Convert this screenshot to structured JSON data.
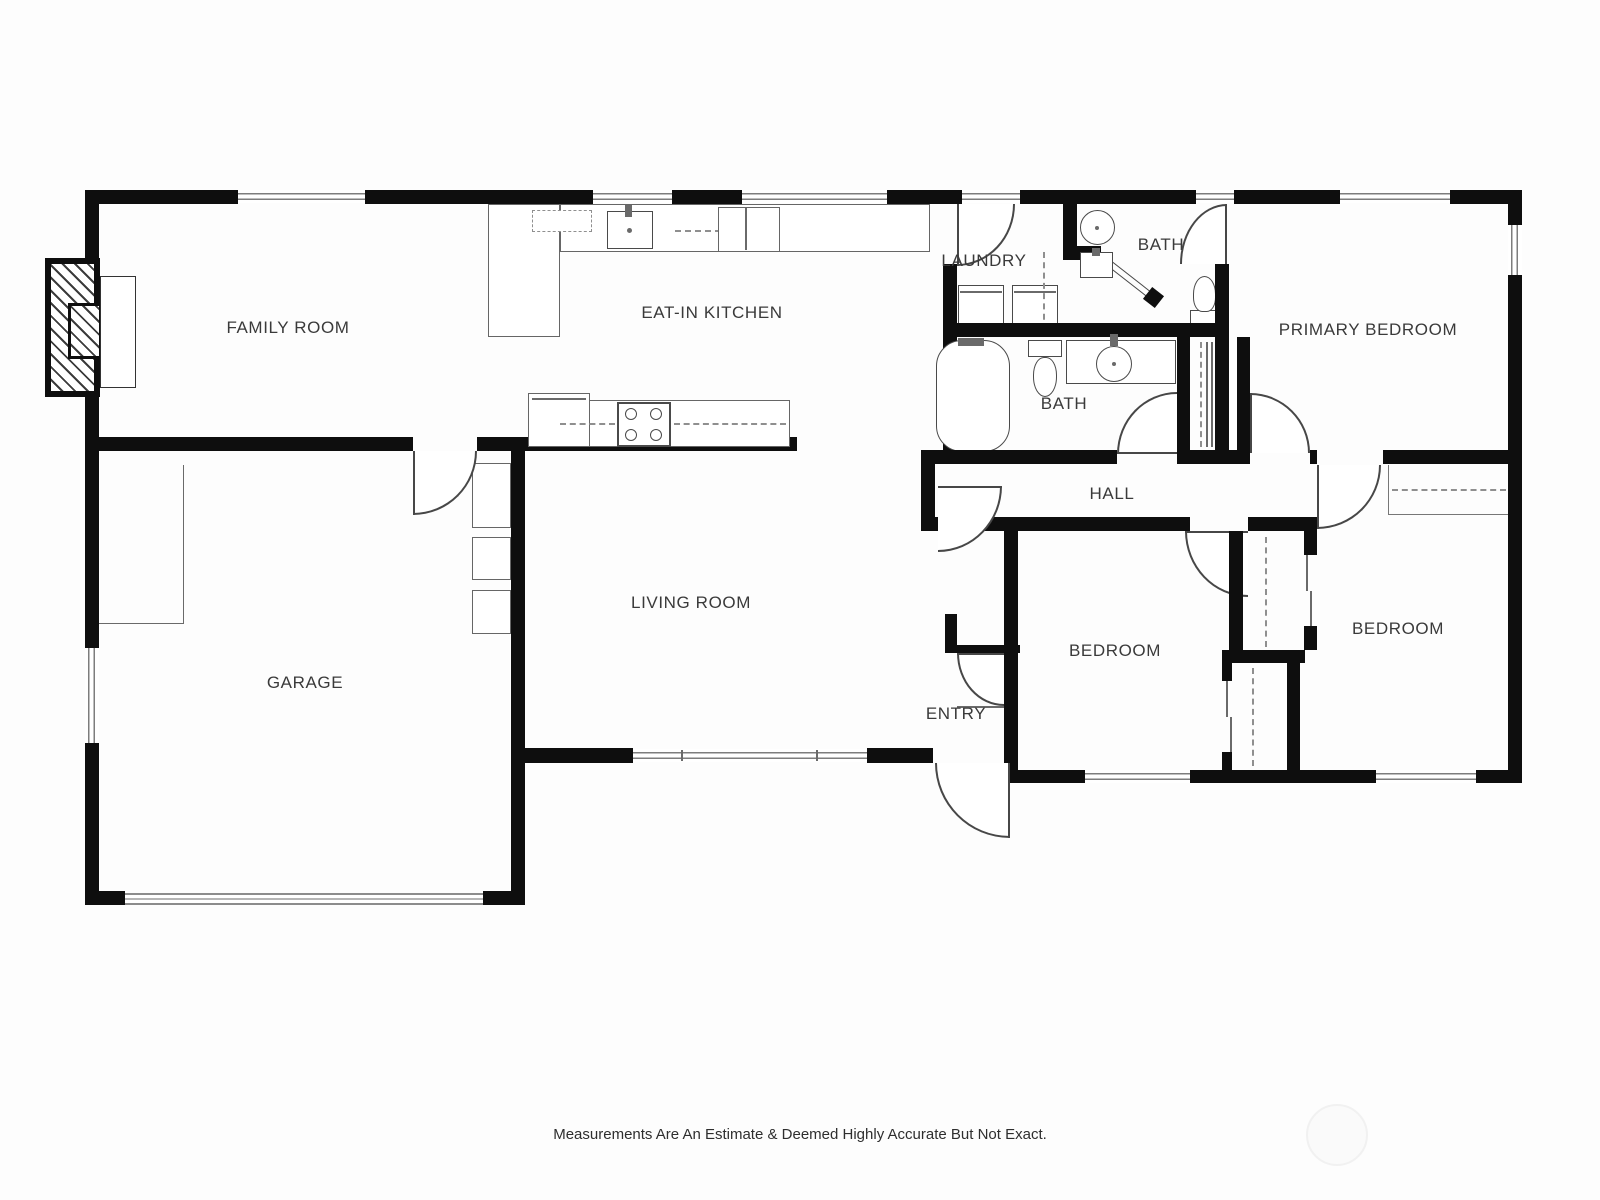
{
  "title": "floor-plan",
  "rooms": [
    {
      "id": "family-room",
      "label": "FAMILY ROOM"
    },
    {
      "id": "eat-in-kitchen",
      "label": "EAT-IN KITCHEN"
    },
    {
      "id": "laundry",
      "label": "LAUNDRY"
    },
    {
      "id": "bath-top",
      "label": "BATH"
    },
    {
      "id": "primary-bedroom",
      "label": "PRIMARY BEDROOM"
    },
    {
      "id": "bath-middle",
      "label": "BATH"
    },
    {
      "id": "hall",
      "label": "HALL"
    },
    {
      "id": "garage",
      "label": "GARAGE"
    },
    {
      "id": "living-room",
      "label": "LIVING ROOM"
    },
    {
      "id": "entry",
      "label": "ENTRY"
    },
    {
      "id": "bedroom-middle",
      "label": "BEDROOM"
    },
    {
      "id": "bedroom-right",
      "label": "BEDROOM"
    }
  ],
  "footer": {
    "disclaimer": "Measurements Are An Estimate & Deemed Highly Accurate But Not Exact."
  },
  "colors": {
    "wall": "#0e0e0e",
    "fixture_line": "#4a4a4a",
    "label_text": "#3a3a3a"
  }
}
